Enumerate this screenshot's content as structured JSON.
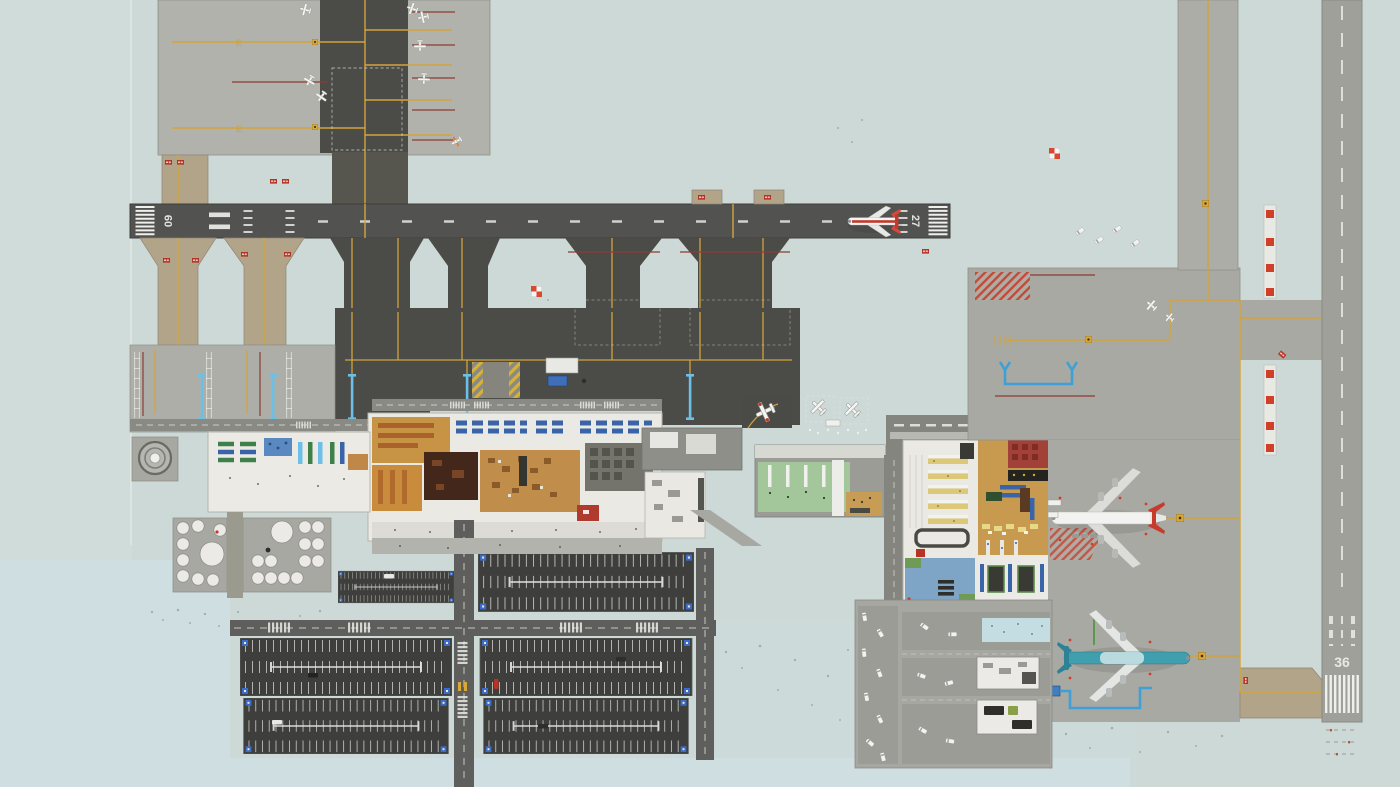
{
  "meta": {
    "app": "airport-builder-game",
    "scene": "top-down airport overview map",
    "canvas": {
      "width": 1400,
      "height": 787
    }
  },
  "palette": {
    "grass": "#ccd9d7",
    "grass_blue": "#cfdee1",
    "apron_light": "#b2b2ac",
    "apron_mid": "#a8a8a2",
    "asphalt_dark": "#4c4c48",
    "runway_main": "#525250",
    "runway_crosswind": "#a0a09a",
    "parking_lot": "#3e3e3c",
    "road": "#5e5e5c",
    "taxiway_tan": "#b2a489",
    "marking_white": "#f0f0ec",
    "taxi_yellow": "#d2a43c",
    "hold_line_red": "#8c3c32",
    "sign_red": "#c23a2c",
    "fuel_pipe_blue": "#3fa0d8",
    "jetbridge_blue": "#6cc0e8",
    "terminal_floor": "#eae9e4",
    "wood_floor": "#c08d4a",
    "dark_brown_room": "#44271b",
    "red_room": "#a24137",
    "machine_room": "#74746d",
    "green_floor": "#a3c79b",
    "bench_blue": "#3a64a8",
    "bench_green": "#3f7f49",
    "desk_yellow": "#ddc878",
    "blue_room": "#7ea4c6",
    "pool": "#c4dde3"
  },
  "runways": {
    "main": {
      "name": "runway-09-27",
      "left_label": "09",
      "right_label": "27"
    },
    "crosswind": {
      "name": "runway-36",
      "label": "36"
    }
  },
  "taxiways": {
    "labels": [
      "E",
      "E"
    ]
  },
  "aircraft": {
    "on_runway": {
      "name": "airliner-red-stripe",
      "position": "runway-09-27",
      "livery_color": "#c23a2c"
    },
    "at_gate": {
      "name": "widebody-red-tail",
      "position": "terminal-gate-stand",
      "livery_color": "#c23a2c"
    },
    "remote": {
      "name": "airliner-teal",
      "position": "remote-stand",
      "livery_color": "#3f9fae"
    },
    "general_aviation_count": 10
  },
  "facilities": {
    "fuel_tanks_small": 20,
    "fuel_tanks_large": 2,
    "parking_cells": 6,
    "terminal_buildings": 2
  }
}
